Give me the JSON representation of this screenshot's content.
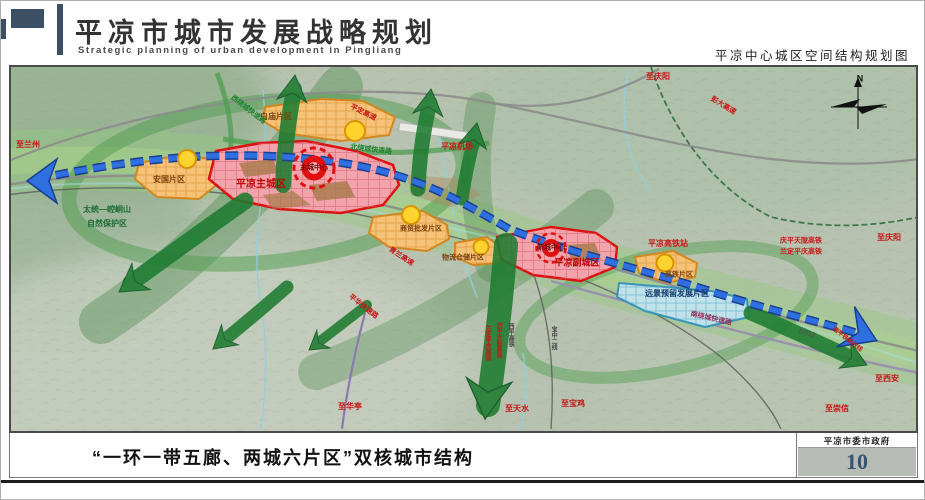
{
  "header": {
    "title": "平凉市城市发展战略规划",
    "subtitle_en": "Strategic planning of urban development in Pingliang",
    "right_caption": "平凉中心城区空间结构规划图"
  },
  "footer": {
    "caption": "“一环一带五廊、两城六片区”双核城市结构",
    "org": "平凉市委市政府",
    "page_number": "10"
  },
  "map": {
    "colors": {
      "city_red": "#e01010",
      "city_fill": "#f2a3ab",
      "district_orange": "#f5c276",
      "node_yellow": "#ffd22e",
      "reserve_blue": "#c2e4ef",
      "corridor_green": "#1e7c31",
      "rail_blue": "#2f6fe0",
      "terrain": "#b7c3b0"
    },
    "labels": [
      {
        "name": "label-to-lanzhou",
        "text": "至兰州",
        "x": 17,
        "y": 78,
        "color": "#c81414",
        "size": 8
      },
      {
        "name": "label-nature-reserve-1",
        "text": "太统—崆峒山",
        "x": 96,
        "y": 143,
        "color": "#1d6b35",
        "size": 8
      },
      {
        "name": "label-nature-reserve-2",
        "text": "自然保护区",
        "x": 96,
        "y": 157,
        "color": "#1d6b35",
        "size": 8
      },
      {
        "name": "label-anguo-district",
        "text": "安国片区",
        "x": 158,
        "y": 113,
        "color": "#79400f",
        "size": 8
      },
      {
        "name": "label-main-city",
        "text": "平凉主城区",
        "x": 250,
        "y": 118,
        "color": "#c00000",
        "size": 10,
        "bold": true
      },
      {
        "name": "label-main-center",
        "text": "主城中心",
        "x": 303,
        "y": 101,
        "color": "#6d0000",
        "size": 7
      },
      {
        "name": "label-baimiao-district",
        "text": "白庙片区",
        "x": 265,
        "y": 50,
        "color": "#79400f",
        "size": 8
      },
      {
        "name": "label-west-ring-road",
        "text": "西绕城快速路",
        "x": 237,
        "y": 43,
        "color": "#20812f",
        "size": 7,
        "rotate": 38
      },
      {
        "name": "label-pingding-expressway",
        "text": "平定高速",
        "x": 352,
        "y": 46,
        "color": "#c81414",
        "size": 7,
        "rotate": 26
      },
      {
        "name": "label-north-ring-road",
        "text": "北绕城快速路",
        "x": 360,
        "y": 83,
        "color": "#20812f",
        "size": 7,
        "rotate": 7
      },
      {
        "name": "label-airport",
        "text": "平凉机场",
        "x": 446,
        "y": 80,
        "color": "#c81414",
        "size": 8
      },
      {
        "name": "label-to-qingyang-top",
        "text": "至庆阳",
        "x": 647,
        "y": 10,
        "color": "#c81414",
        "size": 8
      },
      {
        "name": "label-pengda-expressway",
        "text": "彭大高速",
        "x": 712,
        "y": 39,
        "color": "#c81414",
        "size": 7,
        "rotate": 31
      },
      {
        "name": "label-wholesale-district",
        "text": "商贸批发片区",
        "x": 410,
        "y": 162,
        "color": "#79400f",
        "size": 7
      },
      {
        "name": "label-qinglan-expressway",
        "text": "青兰高速",
        "x": 390,
        "y": 190,
        "color": "#c81414",
        "size": 7,
        "rotate": 33
      },
      {
        "name": "label-logistics-district",
        "text": "物流仓储片区",
        "x": 452,
        "y": 191,
        "color": "#79400f",
        "size": 7
      },
      {
        "name": "label-new-center",
        "text": "新城中心",
        "x": 540,
        "y": 181,
        "color": "#6d0000",
        "size": 7
      },
      {
        "name": "label-sub-city",
        "text": "平凉副城区",
        "x": 566,
        "y": 196,
        "color": "#c00000",
        "size": 9,
        "bold": true
      },
      {
        "name": "label-hsr-station",
        "text": "平凉高铁站",
        "x": 657,
        "y": 177,
        "color": "#c81414",
        "size": 8
      },
      {
        "name": "label-hsr-district",
        "text": "高铁片区",
        "x": 668,
        "y": 208,
        "color": "#79400f",
        "size": 7
      },
      {
        "name": "label-reserved-district",
        "text": "远景预留发展片区",
        "x": 666,
        "y": 227,
        "color": "#173a6e",
        "size": 8
      },
      {
        "name": "label-qingping-hsr",
        "text": "庆平天陇高铁",
        "x": 790,
        "y": 174,
        "color": "#c81414",
        "size": 7
      },
      {
        "name": "label-landing-hsr",
        "text": "兰定平庆高铁",
        "x": 790,
        "y": 185,
        "color": "#c81414",
        "size": 7
      },
      {
        "name": "label-to-qingyang-right",
        "text": "至庆阳",
        "x": 878,
        "y": 171,
        "color": "#c81414",
        "size": 8
      },
      {
        "name": "label-south-ring-road",
        "text": "南绕城快速路",
        "x": 700,
        "y": 252,
        "color": "#93305c",
        "size": 7,
        "rotate": 13
      },
      {
        "name": "label-g312",
        "text": "G312",
        "x": 796,
        "y": 267,
        "color": "#555555",
        "size": 7,
        "rotate": 15
      },
      {
        "name": "label-xiping-railway",
        "text": "西平铁路改线",
        "x": 836,
        "y": 273,
        "color": "#c81414",
        "size": 6,
        "rotate": 38
      },
      {
        "name": "label-to-xian",
        "text": "至西安",
        "x": 876,
        "y": 312,
        "color": "#c81414",
        "size": 8
      },
      {
        "name": "label-to-chongxin",
        "text": "至崇信",
        "x": 826,
        "y": 342,
        "color": "#c81414",
        "size": 8
      },
      {
        "name": "label-pinghua-road",
        "text": "平华快速路",
        "x": 352,
        "y": 240,
        "color": "#c81414",
        "size": 7,
        "rotate": 38
      },
      {
        "name": "label-to-huating",
        "text": "至华亭",
        "x": 339,
        "y": 340,
        "color": "#c81414",
        "size": 8
      },
      {
        "name": "label-landing-hsr-v",
        "text": "兰定平庆高铁",
        "x": 476,
        "y": 276,
        "color": "#c81414",
        "size": 6,
        "vertical": true
      },
      {
        "name": "label-qingping-hsr-v",
        "text": "庆平天陇高铁",
        "x": 487,
        "y": 273,
        "color": "#c81414",
        "size": 6,
        "vertical": true
      },
      {
        "name": "label-xiping-hsr-v",
        "text": "西平高铁",
        "x": 499,
        "y": 268,
        "color": "#444444",
        "size": 6,
        "vertical": true
      },
      {
        "name": "label-baozhong-line-v",
        "text": "宝中二线",
        "x": 542,
        "y": 271,
        "color": "#444444",
        "size": 6,
        "vertical": true
      },
      {
        "name": "label-to-tianshui",
        "text": "至天水",
        "x": 506,
        "y": 342,
        "color": "#c81414",
        "size": 8
      },
      {
        "name": "label-to-baoji",
        "text": "至宝鸡",
        "x": 562,
        "y": 337,
        "color": "#c81414",
        "size": 8
      },
      {
        "name": "label-compass-n",
        "text": "N",
        "x": 849,
        "y": 12,
        "color": "#111111",
        "size": 9,
        "bold": true
      }
    ]
  }
}
